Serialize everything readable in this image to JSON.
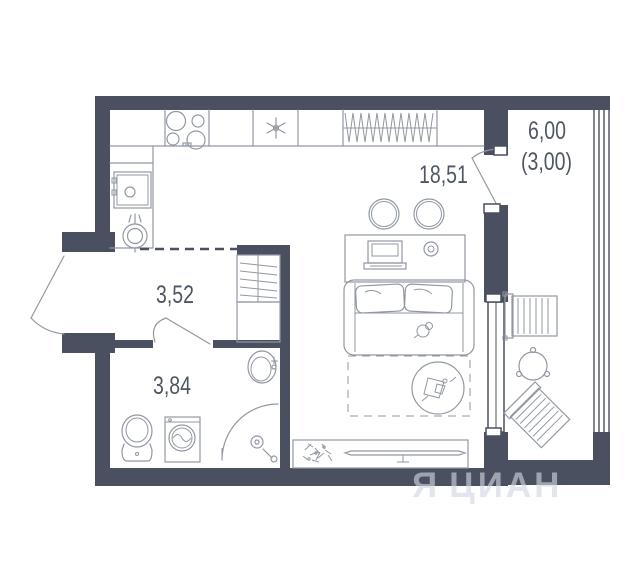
{
  "plan": {
    "rooms": [
      {
        "id": "living-kitchen",
        "area": "18,51"
      },
      {
        "id": "hallway",
        "area": "3,52"
      },
      {
        "id": "bathroom",
        "area": "3,84"
      },
      {
        "id": "balcony",
        "area": "6,00",
        "area_secondary": "(3,00)"
      }
    ],
    "watermark": {
      "logo": "Я",
      "brand": "ЦИАН"
    },
    "colors": {
      "wall": "#4a5060",
      "line": "#9298a3",
      "label": "#4f5663"
    }
  }
}
